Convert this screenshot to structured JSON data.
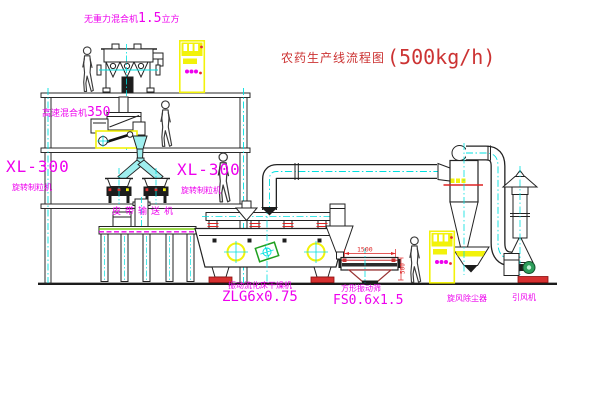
{
  "title": {
    "text": "农药生产线流程图",
    "capacity": "(500kg/h)"
  },
  "colors": {
    "label_magenta": "#EE00EE",
    "title_red": "#CC3333",
    "dimension_red": "#DD2222",
    "centerline_cyan": "#00E0E0",
    "highlight_yellow": "#F2F20A"
  },
  "labels": {
    "mixer_top": {
      "name": "无重力混合机",
      "spec": "1.5",
      "unit": "立方"
    },
    "mixer_hs": {
      "name": "高速混合机",
      "spec": "350"
    },
    "granulator_left": {
      "model": "XL-300",
      "name": "旋转制粒机"
    },
    "granulator_right": {
      "model": "XL-300",
      "name": "旋转制粒机"
    },
    "conveyor": {
      "name": "皮带输送机"
    },
    "dryer": {
      "name": "振动流化床干燥机",
      "model": "ZLG6x0.75"
    },
    "sieve": {
      "name": "方形振动筛",
      "model": "FS0.6x1.5",
      "dim_width": "1500",
      "dim_height": "500"
    },
    "cyclone": {
      "name": "旋风除尘器"
    },
    "fan": {
      "name": "引风机"
    }
  }
}
